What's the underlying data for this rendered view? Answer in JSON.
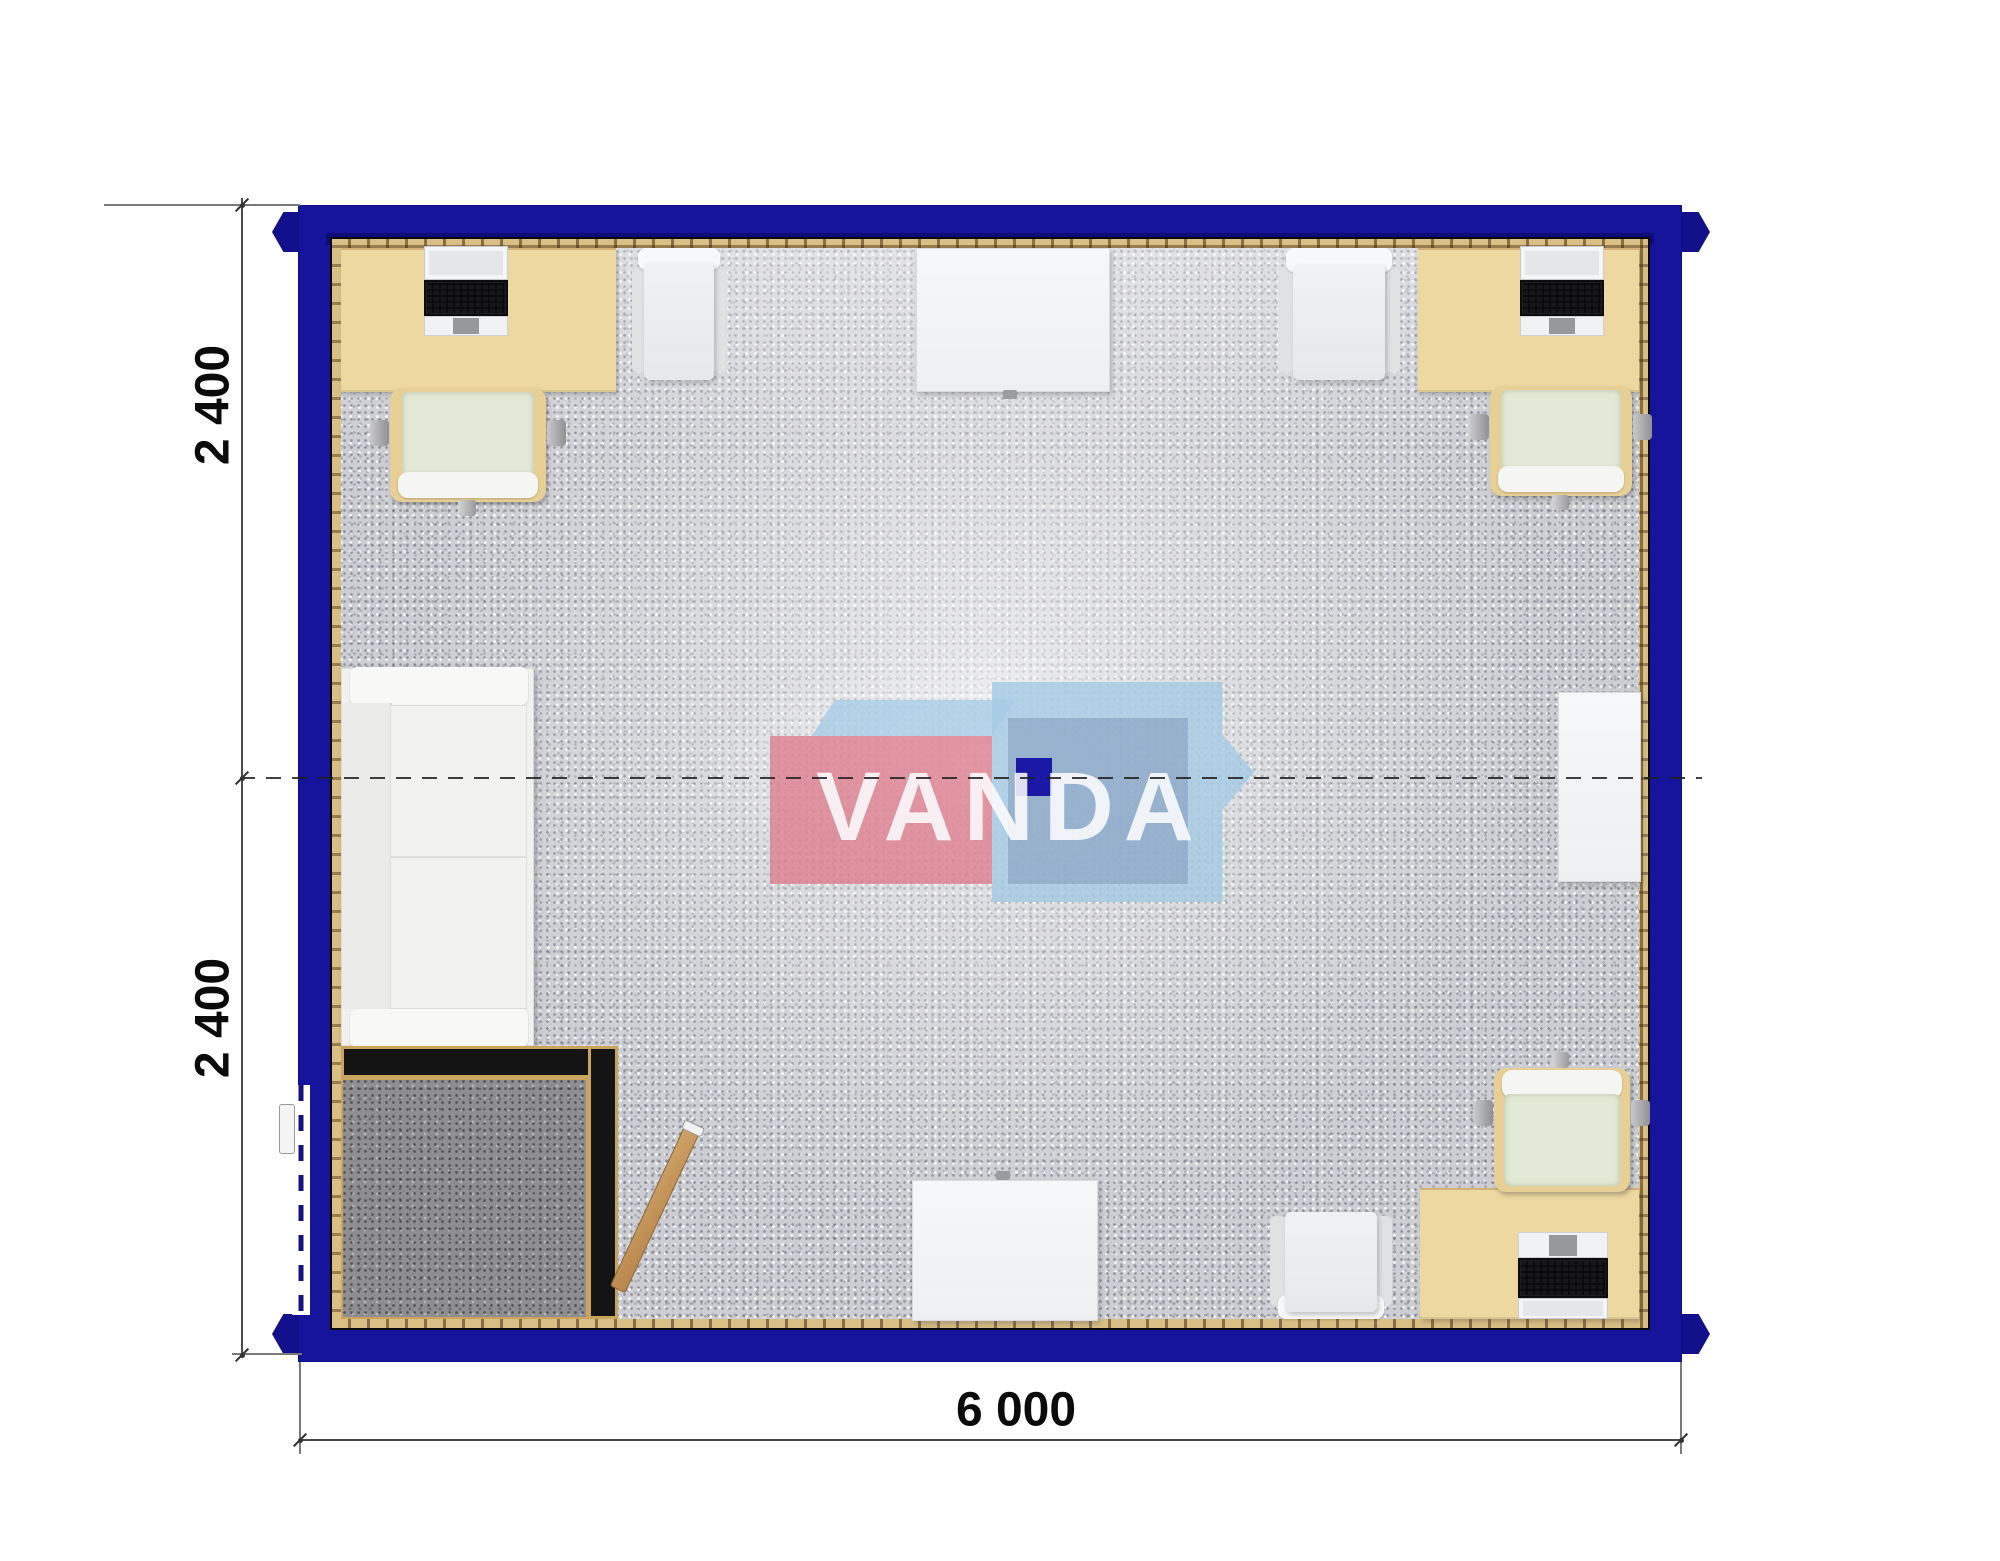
{
  "title": "modular-office-floor-plan",
  "watermark": {
    "text": "VANDA",
    "pink_box_color": "#DD7D8D",
    "blue_box_color": "#A5CAE4",
    "navy_square_color": "#1A18A4"
  },
  "dimensions": {
    "left_top": "2 400",
    "left_bottom": "2 400",
    "bottom": "6 000"
  },
  "colors": {
    "wall": "#16149B",
    "wall_inner_lip": "#0D0C78",
    "perimeter_trim": "#D9BF86",
    "carpet": "#CDCED3",
    "entry_mat": "#8E8E90",
    "desk_beige": "#ECD8A0",
    "chair_seat_green": "#E2E9D6",
    "white_furniture": "#F1F3F4",
    "door_wood": "#C9995C",
    "partition_black": "#141414"
  },
  "rooms": [
    {
      "name": "open-office",
      "floor": "grey-carpet"
    },
    {
      "name": "entry-vestibule",
      "floor": "dark-mat"
    }
  ],
  "furniture": [
    "desk-top-left-with-laptop",
    "office-chair-top-left",
    "visitor-chair-top-left",
    "meeting-table-top",
    "visitor-chair-top-right",
    "desk-top-right-with-laptop",
    "office-chair-top-right",
    "sofa-left-wall",
    "side-table-right-wall",
    "meeting-table-bottom",
    "visitor-chair-bottom",
    "desk-bottom-right-with-laptop",
    "office-chair-bottom-right",
    "entry-door-open-leaf",
    "exterior-door-opening"
  ]
}
